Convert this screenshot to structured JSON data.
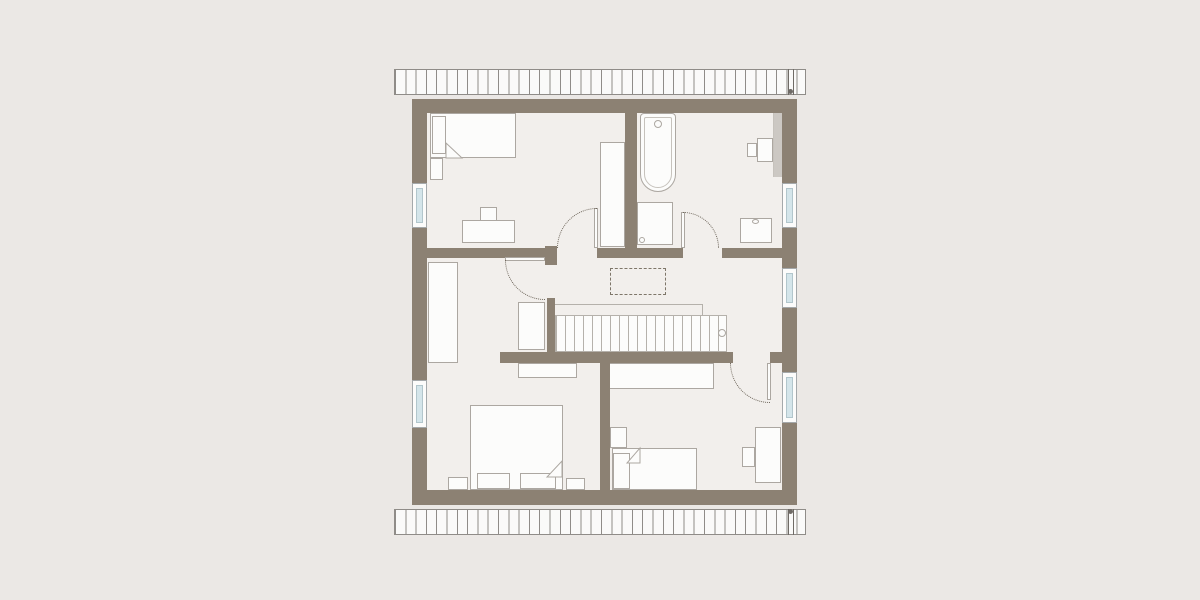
{
  "meta": {
    "description": "architectural-floor-plan-upper-storey",
    "canvas_width": 1200,
    "canvas_height": 600
  },
  "palette": {
    "bg": "#EBE8E5",
    "floor": "#F2EFEC",
    "wall": "#8C8173",
    "paper": "#FCFCFB",
    "line": "#ACA7A1",
    "line2": "#B5B1AB",
    "line3": "#C6C2BC",
    "strip": "#CCC8C3",
    "glass": "#D4E5EA",
    "glassline": "#B2C6CC",
    "winframe": "#A5A9AB",
    "dash": "#7E7669",
    "arc": "#6F675C",
    "roofline": "#8F8C88",
    "dark": "#6F6B66"
  },
  "plan": {
    "shapes": [
      {
        "name": "interior-floor",
        "kind": "floor",
        "x": 412,
        "y": 99,
        "w": 385,
        "h": 406
      },
      {
        "name": "bathroom-wall-shelf-strip",
        "kind": "strip",
        "x": 773,
        "y": 105,
        "w": 9,
        "h": 72
      },
      {
        "name": "child1-bed",
        "kind": "furn",
        "x": 430,
        "y": 113,
        "w": 86,
        "h": 45
      },
      {
        "name": "child1-bed-pillow",
        "kind": "furn",
        "x": 432,
        "y": 116,
        "w": 14,
        "h": 38
      },
      {
        "name": "child1-bed-headboard",
        "kind": "furn",
        "x": 430,
        "y": 158,
        "w": 13,
        "h": 22
      },
      {
        "name": "child1-bed-blanket-fold",
        "kind": "fold",
        "x": 446,
        "y": 143,
        "w": 16,
        "h": 15,
        "pts": "0,0 16,15 0,15"
      },
      {
        "name": "child1-wardrobe",
        "kind": "furn",
        "x": 600,
        "y": 142,
        "w": 25,
        "h": 105
      },
      {
        "name": "child1-desk",
        "kind": "furn",
        "x": 462,
        "y": 220,
        "w": 53,
        "h": 23
      },
      {
        "name": "child1-desk-chair",
        "kind": "furn",
        "x": 480,
        "y": 207,
        "w": 17,
        "h": 14
      },
      {
        "name": "bathtub",
        "kind": "tub",
        "x": 640,
        "y": 113,
        "w": 36,
        "h": 79
      },
      {
        "name": "shower-tray",
        "kind": "furn",
        "x": 637,
        "y": 202,
        "w": 36,
        "h": 43
      },
      {
        "name": "shower-drain",
        "kind": "circle",
        "x": 639,
        "y": 237,
        "w": 6,
        "h": 6
      },
      {
        "name": "washbasin",
        "kind": "furn",
        "x": 740,
        "y": 218,
        "w": 32,
        "h": 25
      },
      {
        "name": "washbasin-tap",
        "kind": "circle",
        "x": 752,
        "y": 219,
        "w": 7,
        "h": 5
      },
      {
        "name": "bath-vanity",
        "kind": "furn",
        "x": 757,
        "y": 138,
        "w": 16,
        "h": 24
      },
      {
        "name": "bath-stool",
        "kind": "furn",
        "x": 747,
        "y": 143,
        "w": 10,
        "h": 14
      },
      {
        "name": "master-wardrobe-left",
        "kind": "furn",
        "x": 428,
        "y": 262,
        "w": 30,
        "h": 101
      },
      {
        "name": "hall-wardrobe",
        "kind": "furn",
        "x": 518,
        "y": 302,
        "w": 27,
        "h": 48
      },
      {
        "name": "master-dresser",
        "kind": "furn",
        "x": 518,
        "y": 363,
        "w": 59,
        "h": 15
      },
      {
        "name": "master-double-bed",
        "kind": "furn",
        "x": 470,
        "y": 405,
        "w": 93,
        "h": 85
      },
      {
        "name": "master-bed-pillow-left",
        "kind": "furn",
        "x": 477,
        "y": 473,
        "w": 33,
        "h": 16
      },
      {
        "name": "master-bed-pillow-right",
        "kind": "furn",
        "x": 520,
        "y": 473,
        "w": 36,
        "h": 16
      },
      {
        "name": "master-bed-blanket-fold",
        "kind": "fold",
        "x": 547,
        "y": 461,
        "w": 15,
        "h": 16,
        "pts": "15,0 15,16 0,16"
      },
      {
        "name": "master-nightstand-left",
        "kind": "furn",
        "x": 448,
        "y": 477,
        "w": 20,
        "h": 13
      },
      {
        "name": "master-nightstand-right",
        "kind": "furn",
        "x": 566,
        "y": 478,
        "w": 19,
        "h": 12
      },
      {
        "name": "child2-sideboard",
        "kind": "furn",
        "x": 608,
        "y": 363,
        "w": 106,
        "h": 26
      },
      {
        "name": "child2-bed-headboard",
        "kind": "furn",
        "x": 610,
        "y": 427,
        "w": 17,
        "h": 21
      },
      {
        "name": "child2-bed",
        "kind": "furn",
        "x": 612,
        "y": 448,
        "w": 85,
        "h": 42
      },
      {
        "name": "child2-bed-pillow",
        "kind": "furn",
        "x": 613,
        "y": 453,
        "w": 17,
        "h": 36
      },
      {
        "name": "child2-bed-blanket-fold",
        "kind": "fold",
        "x": 627,
        "y": 448,
        "w": 13,
        "h": 15,
        "pts": "13,0 13,15 0,15"
      },
      {
        "name": "child2-desk",
        "kind": "furn",
        "x": 755,
        "y": 427,
        "w": 26,
        "h": 56
      },
      {
        "name": "child2-desk-chair",
        "kind": "furn",
        "x": 742,
        "y": 447,
        "w": 13,
        "h": 20
      },
      {
        "name": "staircase",
        "kind": "stairs",
        "x": 555,
        "y": 315,
        "w": 172,
        "h": 37
      },
      {
        "name": "stair-railing",
        "kind": "railing",
        "x": 548,
        "y": 304,
        "w": 155,
        "h": 12
      },
      {
        "name": "stair-newel-circle",
        "kind": "circle",
        "x": 718,
        "y": 329,
        "w": 8,
        "h": 8
      },
      {
        "name": "ceiling-opening-dashed",
        "kind": "dashed",
        "x": 610,
        "y": 268,
        "w": 56,
        "h": 27
      },
      {
        "name": "exterior-wall-top",
        "kind": "wall",
        "x": 412,
        "y": 99,
        "w": 385,
        "h": 14
      },
      {
        "name": "exterior-wall-bottom",
        "kind": "wall",
        "x": 412,
        "y": 490,
        "w": 385,
        "h": 15
      },
      {
        "name": "exterior-wall-left",
        "kind": "wall",
        "x": 412,
        "y": 99,
        "w": 15,
        "h": 406
      },
      {
        "name": "exterior-wall-right",
        "kind": "wall",
        "x": 782,
        "y": 99,
        "w": 15,
        "h": 406
      },
      {
        "name": "bathroom-partition-wall",
        "kind": "wall",
        "x": 625,
        "y": 113,
        "w": 12,
        "h": 145
      },
      {
        "name": "upper-corridor-wall-a",
        "kind": "wall",
        "x": 427,
        "y": 248,
        "w": 118,
        "h": 10
      },
      {
        "name": "door-jamb-block",
        "kind": "wall",
        "x": 545,
        "y": 246,
        "w": 12,
        "h": 19
      },
      {
        "name": "upper-corridor-wall-b",
        "kind": "wall",
        "x": 597,
        "y": 248,
        "w": 86,
        "h": 10
      },
      {
        "name": "upper-corridor-wall-c",
        "kind": "wall",
        "x": 722,
        "y": 248,
        "w": 60,
        "h": 10
      },
      {
        "name": "hall-lower-wall",
        "kind": "wall",
        "x": 500,
        "y": 352,
        "w": 233,
        "h": 11
      },
      {
        "name": "hall-lower-wall-stub",
        "kind": "wall",
        "x": 770,
        "y": 352,
        "w": 12,
        "h": 11
      },
      {
        "name": "master-door-wall",
        "kind": "wall",
        "x": 547,
        "y": 298,
        "w": 8,
        "h": 54
      },
      {
        "name": "bottom-rooms-divider-wall",
        "kind": "wall",
        "x": 600,
        "y": 363,
        "w": 10,
        "h": 127
      },
      {
        "name": "window-left-upper",
        "kind": "window",
        "x": 412,
        "y": 183,
        "w": 15,
        "h": 45
      },
      {
        "name": "window-left-lower",
        "kind": "window",
        "x": 412,
        "y": 380,
        "w": 15,
        "h": 48
      },
      {
        "name": "window-right-upper",
        "kind": "window",
        "x": 782,
        "y": 183,
        "w": 15,
        "h": 45
      },
      {
        "name": "window-right-middle",
        "kind": "window",
        "x": 782,
        "y": 268,
        "w": 15,
        "h": 40
      },
      {
        "name": "window-right-lower",
        "kind": "window",
        "x": 782,
        "y": 372,
        "w": 15,
        "h": 51
      },
      {
        "name": "child1-door-leaf",
        "kind": "leaf",
        "x": 594,
        "y": 208,
        "w": 4,
        "h": 40
      },
      {
        "name": "child1-door-swing",
        "kind": "arc",
        "x": 557,
        "y": 208,
        "w": 40,
        "h": 40,
        "corner": "tl"
      },
      {
        "name": "master-door-leaf",
        "kind": "leaf",
        "x": 505,
        "y": 257,
        "w": 40,
        "h": 4
      },
      {
        "name": "master-door-swing",
        "kind": "arc",
        "x": 505,
        "y": 260,
        "w": 40,
        "h": 40,
        "corner": "bl"
      },
      {
        "name": "bathroom-door-leaf",
        "kind": "leaf",
        "x": 681,
        "y": 212,
        "w": 4,
        "h": 36
      },
      {
        "name": "bathroom-door-swing",
        "kind": "arc",
        "x": 683,
        "y": 212,
        "w": 36,
        "h": 36,
        "corner": "tr"
      },
      {
        "name": "child2-door-leaf",
        "kind": "leaf",
        "x": 767,
        "y": 363,
        "w": 4,
        "h": 37
      },
      {
        "name": "child2-door-swing",
        "kind": "arc",
        "x": 730,
        "y": 363,
        "w": 40,
        "h": 40,
        "corner": "bl"
      },
      {
        "name": "roof-overhang-top",
        "kind": "hatch",
        "x": 394,
        "y": 69,
        "w": 412,
        "h": 26
      },
      {
        "name": "roof-overhang-bottom",
        "kind": "hatch",
        "x": 394,
        "y": 509,
        "w": 412,
        "h": 26
      },
      {
        "name": "roof-gutter-line-top-1",
        "kind": "dline",
        "x": 788,
        "y": 69,
        "w": 1,
        "h": 26
      },
      {
        "name": "roof-gutter-line-top-2",
        "kind": "dline",
        "x": 793,
        "y": 69,
        "w": 1,
        "h": 26
      },
      {
        "name": "roof-gutter-dot-top",
        "kind": "dot",
        "x": 788,
        "y": 89,
        "w": 5,
        "h": 5
      },
      {
        "name": "roof-gutter-line-bottom-1",
        "kind": "dline",
        "x": 788,
        "y": 509,
        "w": 1,
        "h": 26
      },
      {
        "name": "roof-gutter-line-bottom-2",
        "kind": "dline",
        "x": 793,
        "y": 509,
        "w": 1,
        "h": 26
      },
      {
        "name": "roof-gutter-dot-bottom",
        "kind": "dot",
        "x": 788,
        "y": 509,
        "w": 5,
        "h": 5
      }
    ]
  }
}
